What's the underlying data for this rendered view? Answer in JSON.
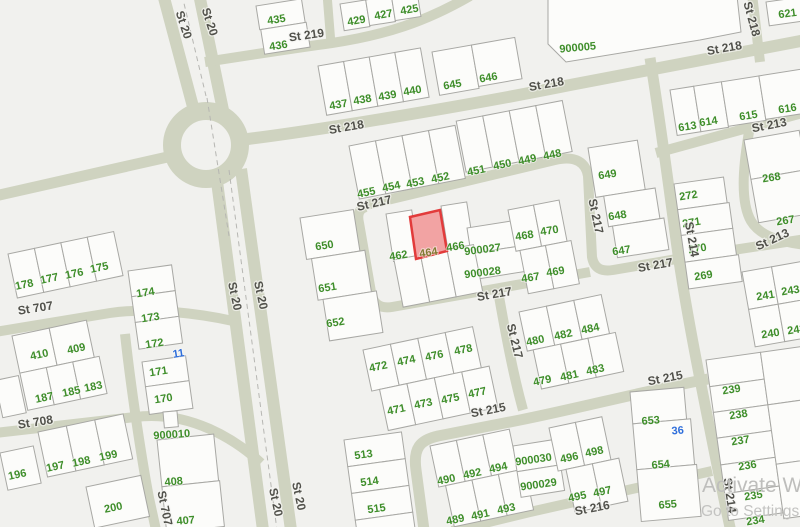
{
  "map": {
    "background": "#f1f1ee",
    "road_color": "#cfd3c0",
    "parcel_fill": "#fcfcfa",
    "parcel_stroke": "#a8a8a4",
    "label_colors": {
      "green": "#3e8e2a",
      "blue": "#2e6edb",
      "olive": "#827c34"
    },
    "street_label_color": "#51514b",
    "highlight": {
      "parcel": "464",
      "fill": "#f2a3a3",
      "stroke": "#e23b3b"
    },
    "watermark": {
      "line1": "Activate Windows",
      "line2": "Go to Settings to activate"
    },
    "street_labels": [
      {
        "t": "St 20",
        "x": 180,
        "y": 26,
        "r": 72
      },
      {
        "t": "St 20",
        "x": 206,
        "y": 23,
        "r": 72
      },
      {
        "t": "St 219",
        "x": 307,
        "y": 39,
        "r": -8
      },
      {
        "t": "St 218",
        "x": 347,
        "y": 131,
        "r": -10
      },
      {
        "t": "St 218",
        "x": 547,
        "y": 88,
        "r": -10
      },
      {
        "t": "St 218",
        "x": 725,
        "y": 52,
        "r": -10
      },
      {
        "t": "St 218",
        "x": 748,
        "y": 20,
        "r": 75
      },
      {
        "t": "St 213",
        "x": 770,
        "y": 129,
        "r": -11
      },
      {
        "t": "St 213",
        "x": 774,
        "y": 243,
        "r": -25
      },
      {
        "t": "St 217",
        "x": 375,
        "y": 207,
        "r": -13
      },
      {
        "t": "St 217",
        "x": 592,
        "y": 217,
        "r": 78
      },
      {
        "t": "St 217",
        "x": 495,
        "y": 298,
        "r": -10
      },
      {
        "t": "St 217",
        "x": 656,
        "y": 269,
        "r": -10
      },
      {
        "t": "St 217",
        "x": 511,
        "y": 342,
        "r": 76
      },
      {
        "t": "St 214",
        "x": 688,
        "y": 240,
        "r": 80
      },
      {
        "t": "St 214",
        "x": 726,
        "y": 496,
        "r": 82
      },
      {
        "t": "St 215",
        "x": 489,
        "y": 414,
        "r": -11
      },
      {
        "t": "St 215",
        "x": 666,
        "y": 382,
        "r": -11
      },
      {
        "t": "St 216",
        "x": 593,
        "y": 512,
        "r": -11
      },
      {
        "t": "St 707",
        "x": 36,
        "y": 312,
        "r": -9
      },
      {
        "t": "St 707",
        "x": 161,
        "y": 509,
        "r": 78
      },
      {
        "t": "St 708",
        "x": 36,
        "y": 426,
        "r": -9
      },
      {
        "t": "St 20",
        "x": 231,
        "y": 297,
        "r": 78
      },
      {
        "t": "St 20",
        "x": 257,
        "y": 296,
        "r": 78
      },
      {
        "t": "St 20",
        "x": 272,
        "y": 503,
        "r": 78
      },
      {
        "t": "St 20",
        "x": 295,
        "y": 497,
        "r": 78
      }
    ],
    "parcel_labels": [
      {
        "t": "435",
        "x": 277,
        "y": 23,
        "r": -9
      },
      {
        "t": "436",
        "x": 279,
        "y": 49,
        "r": -9
      },
      {
        "t": "429",
        "x": 357,
        "y": 24,
        "r": -10
      },
      {
        "t": "427",
        "x": 384,
        "y": 18,
        "r": -10
      },
      {
        "t": "425",
        "x": 410,
        "y": 13,
        "r": -10
      },
      {
        "t": "437",
        "x": 339,
        "y": 108,
        "r": -10
      },
      {
        "t": "438",
        "x": 363,
        "y": 103,
        "r": -10
      },
      {
        "t": "439",
        "x": 388,
        "y": 99,
        "r": -10
      },
      {
        "t": "440",
        "x": 413,
        "y": 94,
        "r": -10
      },
      {
        "t": "645",
        "x": 453,
        "y": 88,
        "r": -10
      },
      {
        "t": "646",
        "x": 489,
        "y": 81,
        "r": -10
      },
      {
        "t": "900005",
        "x": 578,
        "y": 51,
        "r": -5
      },
      {
        "t": "621",
        "x": 788,
        "y": 17,
        "r": -8
      },
      {
        "t": "613",
        "x": 688,
        "y": 130,
        "r": -9
      },
      {
        "t": "614",
        "x": 709,
        "y": 125,
        "r": -9
      },
      {
        "t": "615",
        "x": 749,
        "y": 119,
        "r": -9
      },
      {
        "t": "616",
        "x": 788,
        "y": 112,
        "r": -9
      },
      {
        "t": "455",
        "x": 367,
        "y": 196,
        "r": -12
      },
      {
        "t": "454",
        "x": 392,
        "y": 190,
        "r": -12
      },
      {
        "t": "453",
        "x": 416,
        "y": 186,
        "r": -12
      },
      {
        "t": "452",
        "x": 441,
        "y": 181,
        "r": -12
      },
      {
        "t": "451",
        "x": 477,
        "y": 174,
        "r": -12
      },
      {
        "t": "450",
        "x": 503,
        "y": 168,
        "r": -12
      },
      {
        "t": "449",
        "x": 528,
        "y": 163,
        "r": -12
      },
      {
        "t": "448",
        "x": 553,
        "y": 158,
        "r": -12
      },
      {
        "t": "649",
        "x": 608,
        "y": 178,
        "r": -9
      },
      {
        "t": "648",
        "x": 618,
        "y": 219,
        "r": -9
      },
      {
        "t": "647",
        "x": 622,
        "y": 254,
        "r": -9
      },
      {
        "t": "650",
        "x": 325,
        "y": 249,
        "r": -9
      },
      {
        "t": "651",
        "x": 328,
        "y": 291,
        "r": -9
      },
      {
        "t": "652",
        "x": 336,
        "y": 326,
        "r": -9
      },
      {
        "t": "462",
        "x": 399,
        "y": 259,
        "r": -9
      },
      {
        "t": "464",
        "x": 429,
        "y": 256,
        "r": -9,
        "c": "olive"
      },
      {
        "t": "466",
        "x": 456,
        "y": 250,
        "r": -9
      },
      {
        "t": "900027",
        "x": 483,
        "y": 253,
        "r": -7
      },
      {
        "t": "900028",
        "x": 483,
        "y": 276,
        "r": -7
      },
      {
        "t": "468",
        "x": 525,
        "y": 239,
        "r": -9
      },
      {
        "t": "470",
        "x": 550,
        "y": 234,
        "r": -9
      },
      {
        "t": "467",
        "x": 531,
        "y": 281,
        "r": -9
      },
      {
        "t": "469",
        "x": 556,
        "y": 275,
        "r": -9
      },
      {
        "t": "272",
        "x": 689,
        "y": 199,
        "r": -9
      },
      {
        "t": "271",
        "x": 692,
        "y": 226,
        "r": -9
      },
      {
        "t": "270",
        "x": 698,
        "y": 252,
        "r": -9
      },
      {
        "t": "269",
        "x": 704,
        "y": 279,
        "r": -9
      },
      {
        "t": "268",
        "x": 772,
        "y": 181,
        "r": -9
      },
      {
        "t": "267",
        "x": 786,
        "y": 224,
        "r": -9
      },
      {
        "t": "241",
        "x": 766,
        "y": 299,
        "r": -9
      },
      {
        "t": "243",
        "x": 791,
        "y": 294,
        "r": -9
      },
      {
        "t": "240",
        "x": 771,
        "y": 337,
        "r": -9
      },
      {
        "t": "242",
        "x": 797,
        "y": 333,
        "r": -9
      },
      {
        "t": "178",
        "x": 25,
        "y": 288,
        "r": -12
      },
      {
        "t": "177",
        "x": 50,
        "y": 282,
        "r": -12
      },
      {
        "t": "176",
        "x": 75,
        "y": 277,
        "r": -12
      },
      {
        "t": "175",
        "x": 100,
        "y": 271,
        "r": -12
      },
      {
        "t": "174",
        "x": 146,
        "y": 296,
        "r": -9
      },
      {
        "t": "173",
        "x": 151,
        "y": 321,
        "r": -9
      },
      {
        "t": "172",
        "x": 155,
        "y": 347,
        "r": -9
      },
      {
        "t": "11",
        "x": 179,
        "y": 357,
        "r": -9,
        "c": "blue"
      },
      {
        "t": "171",
        "x": 159,
        "y": 375,
        "r": -9
      },
      {
        "t": "170",
        "x": 164,
        "y": 402,
        "r": -9
      },
      {
        "t": "410",
        "x": 40,
        "y": 358,
        "r": -12
      },
      {
        "t": "409",
        "x": 77,
        "y": 352,
        "r": -12
      },
      {
        "t": "187",
        "x": 45,
        "y": 401,
        "r": -12
      },
      {
        "t": "185",
        "x": 72,
        "y": 395,
        "r": -12
      },
      {
        "t": "183",
        "x": 94,
        "y": 390,
        "r": -12
      },
      {
        "t": "196",
        "x": 18,
        "y": 478,
        "r": -12
      },
      {
        "t": "197",
        "x": 56,
        "y": 470,
        "r": -12
      },
      {
        "t": "198",
        "x": 82,
        "y": 465,
        "r": -12
      },
      {
        "t": "199",
        "x": 109,
        "y": 459,
        "r": -12
      },
      {
        "t": "200",
        "x": 114,
        "y": 511,
        "r": -12
      },
      {
        "t": "900010",
        "x": 172,
        "y": 438,
        "r": -4
      },
      {
        "t": "408",
        "x": 174,
        "y": 485,
        "r": -5
      },
      {
        "t": "407",
        "x": 186,
        "y": 524,
        "r": -5
      },
      {
        "t": "472",
        "x": 379,
        "y": 370,
        "r": -12
      },
      {
        "t": "474",
        "x": 407,
        "y": 364,
        "r": -12
      },
      {
        "t": "476",
        "x": 435,
        "y": 359,
        "r": -12
      },
      {
        "t": "478",
        "x": 464,
        "y": 353,
        "r": -12
      },
      {
        "t": "471",
        "x": 397,
        "y": 413,
        "r": -12
      },
      {
        "t": "473",
        "x": 424,
        "y": 407,
        "r": -12
      },
      {
        "t": "475",
        "x": 451,
        "y": 402,
        "r": -12
      },
      {
        "t": "477",
        "x": 478,
        "y": 396,
        "r": -12
      },
      {
        "t": "480",
        "x": 536,
        "y": 344,
        "r": -12
      },
      {
        "t": "482",
        "x": 564,
        "y": 338,
        "r": -12
      },
      {
        "t": "484",
        "x": 591,
        "y": 332,
        "r": -12
      },
      {
        "t": "479",
        "x": 543,
        "y": 384,
        "r": -12
      },
      {
        "t": "481",
        "x": 570,
        "y": 379,
        "r": -12
      },
      {
        "t": "483",
        "x": 596,
        "y": 373,
        "r": -12
      },
      {
        "t": "513",
        "x": 364,
        "y": 458,
        "r": -8
      },
      {
        "t": "514",
        "x": 370,
        "y": 485,
        "r": -8
      },
      {
        "t": "515",
        "x": 377,
        "y": 512,
        "r": -8
      },
      {
        "t": "490",
        "x": 447,
        "y": 483,
        "r": -12
      },
      {
        "t": "492",
        "x": 473,
        "y": 477,
        "r": -12
      },
      {
        "t": "494",
        "x": 499,
        "y": 471,
        "r": -12
      },
      {
        "t": "489",
        "x": 456,
        "y": 523,
        "r": -12
      },
      {
        "t": "491",
        "x": 481,
        "y": 518,
        "r": -12
      },
      {
        "t": "493",
        "x": 507,
        "y": 512,
        "r": -12
      },
      {
        "t": "900030",
        "x": 534,
        "y": 463,
        "r": -8
      },
      {
        "t": "900029",
        "x": 539,
        "y": 488,
        "r": -8
      },
      {
        "t": "496",
        "x": 570,
        "y": 461,
        "r": -12
      },
      {
        "t": "498",
        "x": 595,
        "y": 455,
        "r": -12
      },
      {
        "t": "495",
        "x": 578,
        "y": 500,
        "r": -12
      },
      {
        "t": "497",
        "x": 603,
        "y": 495,
        "r": -12
      },
      {
        "t": "653",
        "x": 651,
        "y": 424,
        "r": -5
      },
      {
        "t": "36",
        "x": 678,
        "y": 434,
        "r": -5,
        "c": "blue"
      },
      {
        "t": "654",
        "x": 661,
        "y": 468,
        "r": -5
      },
      {
        "t": "655",
        "x": 668,
        "y": 508,
        "r": -5
      },
      {
        "t": "239",
        "x": 732,
        "y": 393,
        "r": -9
      },
      {
        "t": "238",
        "x": 739,
        "y": 418,
        "r": -9
      },
      {
        "t": "237",
        "x": 741,
        "y": 444,
        "r": -9
      },
      {
        "t": "236",
        "x": 748,
        "y": 469,
        "r": -9
      },
      {
        "t": "235",
        "x": 754,
        "y": 499,
        "r": -9
      },
      {
        "t": "234",
        "x": 756,
        "y": 524,
        "r": -9
      }
    ]
  }
}
